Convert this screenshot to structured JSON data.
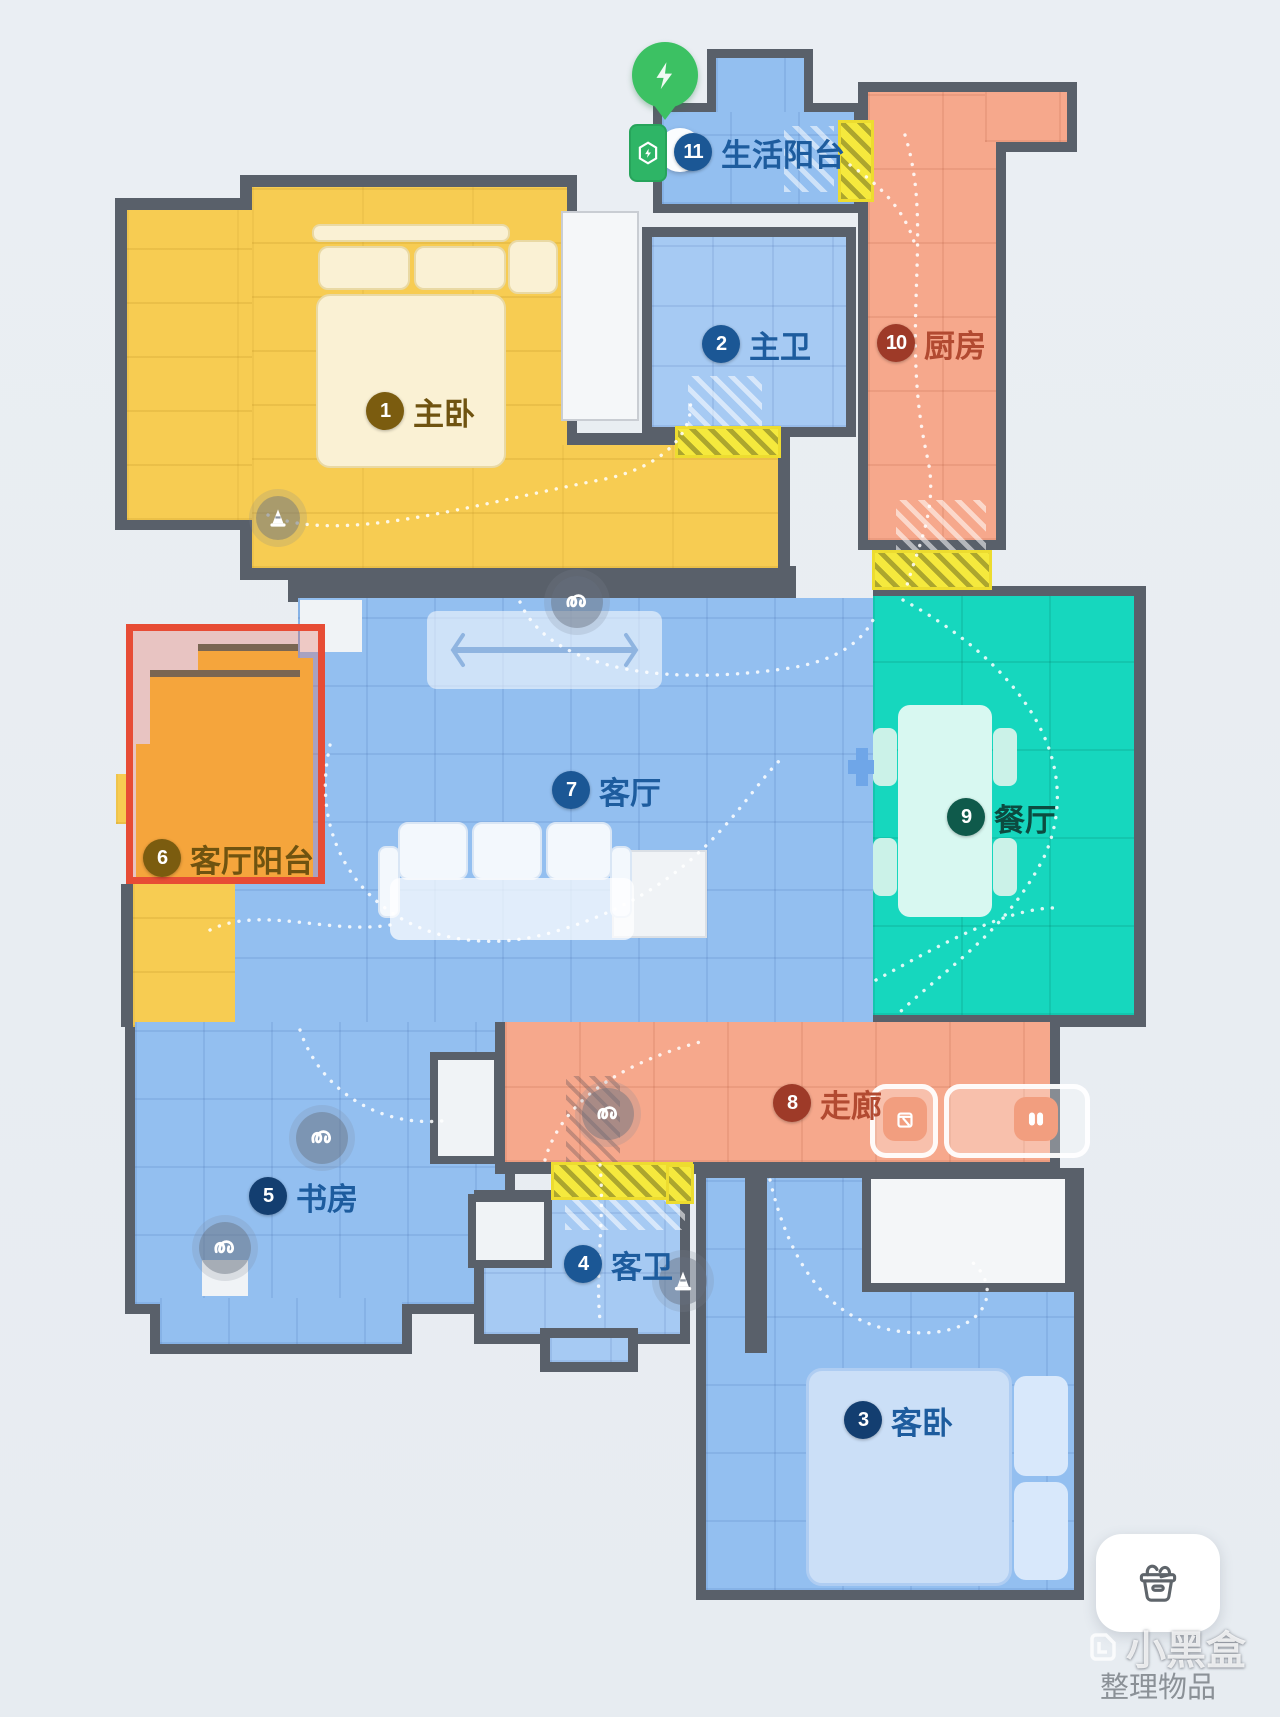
{
  "rooms": [
    {
      "num": "1",
      "label": "主卧"
    },
    {
      "num": "2",
      "label": "主卫"
    },
    {
      "num": "3",
      "label": "客卧"
    },
    {
      "num": "4",
      "label": "客卫"
    },
    {
      "num": "5",
      "label": "书房"
    },
    {
      "num": "6",
      "label": "客厅阳台"
    },
    {
      "num": "7",
      "label": "客厅"
    },
    {
      "num": "8",
      "label": "走廊"
    },
    {
      "num": "9",
      "label": "餐厅"
    },
    {
      "num": "10",
      "label": "厨房"
    },
    {
      "num": "11",
      "label": "生活阳台"
    }
  ],
  "ui": {
    "organize_button": "整理物品",
    "watermark": "小黑盒"
  },
  "icons": {
    "pin": "charge-lightning-pin",
    "dock": "charging-dock",
    "squiggle": "tangle-hazard-marker",
    "cone": "obstacle-cone-marker",
    "bin": "detected-bin",
    "slippers": "detected-slippers",
    "box": "organize-items-box"
  },
  "colors": {
    "wall": "#59606A",
    "background": "#E9EDF2",
    "room_yellow": "#F7CC52",
    "room_blue": "#93BFF0",
    "room_teal": "#16D7BE",
    "room_salmon": "#F6A88C",
    "room_orange": "#F5A53C",
    "selection_border": "#E74C35",
    "threshold": "#F5E93D",
    "dock_green": "#2EB566",
    "pin_green": "#3CC163"
  }
}
